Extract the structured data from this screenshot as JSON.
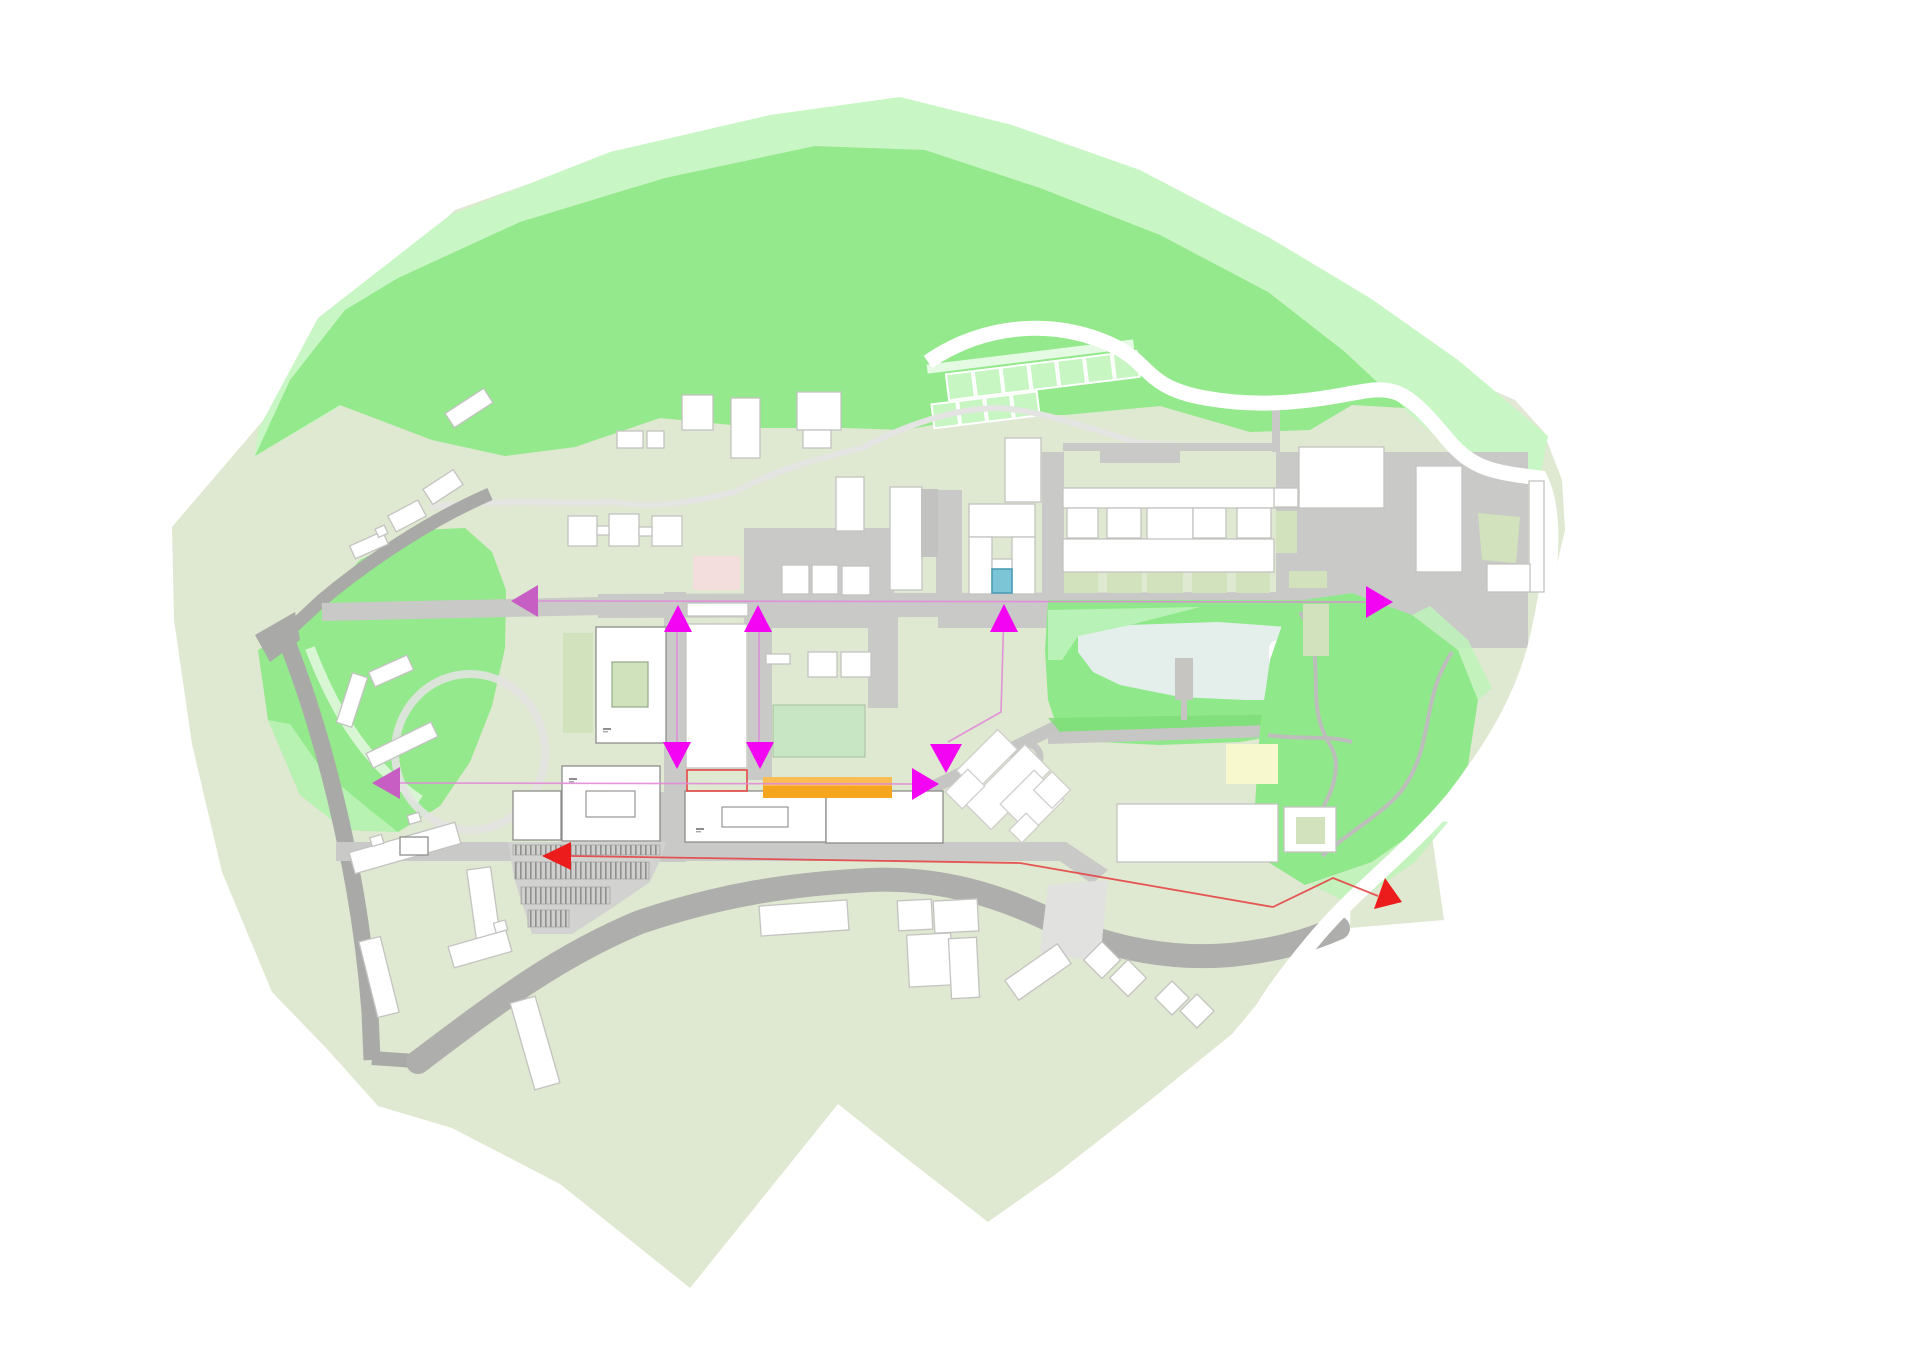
{
  "canvas": {
    "width": 1920,
    "height": 1358,
    "background": "#ffffff"
  },
  "palette": {
    "background": "#ffffff",
    "site_base": "#dfe8d0",
    "site_base_ne": "#e3e8d6",
    "hill_green": "#93e98b",
    "hill_mint": "#c9f6c5",
    "park_mint": "#bdf3b8",
    "lawn": "#c8e6c4",
    "courtyard_sage": "#d2e2bc",
    "road_gray": "#c9c9c7",
    "road_dark": "#a9a9a7",
    "plaza_light": "#dddddb",
    "path_white": "#ffffff",
    "building_fill": "#ffffff",
    "building_stroke": "#c3c3c1",
    "building_stroke_dark": "#8d8d8b",
    "water": "#e4efec",
    "magenta": "#f304f3",
    "magenta_muted": "#c75ec4",
    "magenta_line": "#e18ad8",
    "red": "#ed1c1c",
    "red_line": "#e64545",
    "orange": "#f5a61e",
    "orange_light": "#f8bd55",
    "yellow": "#f8f8cf",
    "pink": "#f3dedd",
    "cyan": "#7cc5d6"
  },
  "annotations": {
    "arrows": [
      {
        "name": "view-arrow-west-upper",
        "color": "magenta_muted",
        "points": [
          [
            511,
            601
          ],
          [
            538,
            585
          ],
          [
            538,
            617
          ]
        ]
      },
      {
        "name": "view-arrow-west-lower",
        "color": "magenta_muted",
        "points": [
          [
            372,
            783
          ],
          [
            400,
            767
          ],
          [
            400,
            799
          ]
        ]
      },
      {
        "name": "entrance-arrow-up-left",
        "color": "magenta",
        "points": [
          [
            678,
            605
          ],
          [
            664,
            632
          ],
          [
            692,
            632
          ]
        ]
      },
      {
        "name": "entrance-arrow-up-right",
        "color": "magenta",
        "points": [
          [
            758,
            605
          ],
          [
            744,
            632
          ],
          [
            772,
            632
          ]
        ]
      },
      {
        "name": "entrance-arrow-down-left",
        "color": "magenta",
        "points": [
          [
            677,
            769
          ],
          [
            663,
            742
          ],
          [
            691,
            742
          ]
        ]
      },
      {
        "name": "entrance-arrow-down-right",
        "color": "magenta",
        "points": [
          [
            760,
            769
          ],
          [
            746,
            742
          ],
          [
            774,
            742
          ]
        ]
      },
      {
        "name": "entrance-arrow-up-center",
        "color": "magenta",
        "points": [
          [
            1004,
            604
          ],
          [
            990,
            632
          ],
          [
            1018,
            632
          ]
        ]
      },
      {
        "name": "entrance-arrow-down-center",
        "color": "magenta",
        "points": [
          [
            946,
            773
          ],
          [
            930,
            744
          ],
          [
            962,
            744
          ]
        ]
      },
      {
        "name": "entrance-arrow-right-center",
        "color": "magenta",
        "points": [
          [
            939,
            784
          ],
          [
            912,
            768
          ],
          [
            912,
            800
          ]
        ]
      },
      {
        "name": "entrance-arrow-right-east",
        "color": "magenta",
        "points": [
          [
            1393,
            602
          ],
          [
            1366,
            586
          ],
          [
            1366,
            618
          ]
        ]
      },
      {
        "name": "access-arrow-red-west",
        "color": "red",
        "points": [
          [
            542,
            856
          ],
          [
            571,
            842
          ],
          [
            571,
            870
          ]
        ]
      },
      {
        "name": "access-arrow-red-east",
        "color": "red",
        "points": [
          [
            1374,
            909
          ],
          [
            1402,
            902
          ],
          [
            1385,
            878
          ]
        ]
      }
    ],
    "lines": [
      {
        "name": "sight-line-upper",
        "color": "magenta_line",
        "width": 1.6,
        "points": [
          [
            538,
            601
          ],
          [
            1366,
            602
          ]
        ]
      },
      {
        "name": "sight-line-lower",
        "color": "magenta_line",
        "width": 1.6,
        "points": [
          [
            400,
            783
          ],
          [
            912,
            784
          ]
        ]
      },
      {
        "name": "link-line-left",
        "color": "magenta_line",
        "width": 1.6,
        "points": [
          [
            677,
            612
          ],
          [
            677,
            762
          ]
        ]
      },
      {
        "name": "link-line-right",
        "color": "magenta_line",
        "width": 1.6,
        "points": [
          [
            759,
            612
          ],
          [
            759,
            762
          ]
        ]
      },
      {
        "name": "link-line-center",
        "color": "magenta_line",
        "width": 1.6,
        "points": [
          [
            1004,
            610
          ],
          [
            1001,
            712
          ],
          [
            948,
            742
          ]
        ]
      },
      {
        "name": "access-route-red",
        "color": "red_line",
        "width": 1.8,
        "points": [
          [
            571,
            856
          ],
          [
            1020,
            863
          ],
          [
            1273,
            907
          ],
          [
            1333,
            878
          ],
          [
            1378,
            896
          ]
        ]
      }
    ],
    "highlights": [
      {
        "name": "orange-program-bar",
        "x": 763,
        "y": 777,
        "w": 129,
        "h": 21,
        "fill": "orange"
      },
      {
        "name": "orange-program-bar-top",
        "x": 763,
        "y": 777,
        "w": 129,
        "h": 9,
        "fill": "orange_light"
      },
      {
        "name": "red-outline-plot",
        "x": 687,
        "y": 770,
        "w": 60,
        "h": 21,
        "stroke": "red_line"
      },
      {
        "name": "pink-building-footprint",
        "x": 693,
        "y": 556,
        "w": 47,
        "h": 34,
        "fill": "pink"
      },
      {
        "name": "yellow-court",
        "x": 1226,
        "y": 744,
        "w": 52,
        "h": 40,
        "fill": "yellow"
      },
      {
        "name": "cyan-plunge-pool",
        "x": 992,
        "y": 569,
        "w": 20,
        "h": 24,
        "fill": "cyan",
        "stroke": "#4e9cb4"
      }
    ],
    "label_marks": [
      [
        603,
        728
      ],
      [
        569,
        778
      ],
      [
        696,
        828
      ]
    ]
  },
  "parking": {
    "surface": [
      [
        508,
        842
      ],
      [
        666,
        842
      ],
      [
        660,
        860
      ],
      [
        650,
        882
      ],
      [
        612,
        908
      ],
      [
        572,
        934
      ],
      [
        532,
        934
      ],
      [
        514,
        878
      ]
    ],
    "rows": [
      [
        513,
        845,
        147,
        10
      ],
      [
        515,
        862,
        134,
        17
      ],
      [
        521,
        887,
        89,
        17
      ],
      [
        528,
        910,
        41,
        17
      ]
    ]
  }
}
